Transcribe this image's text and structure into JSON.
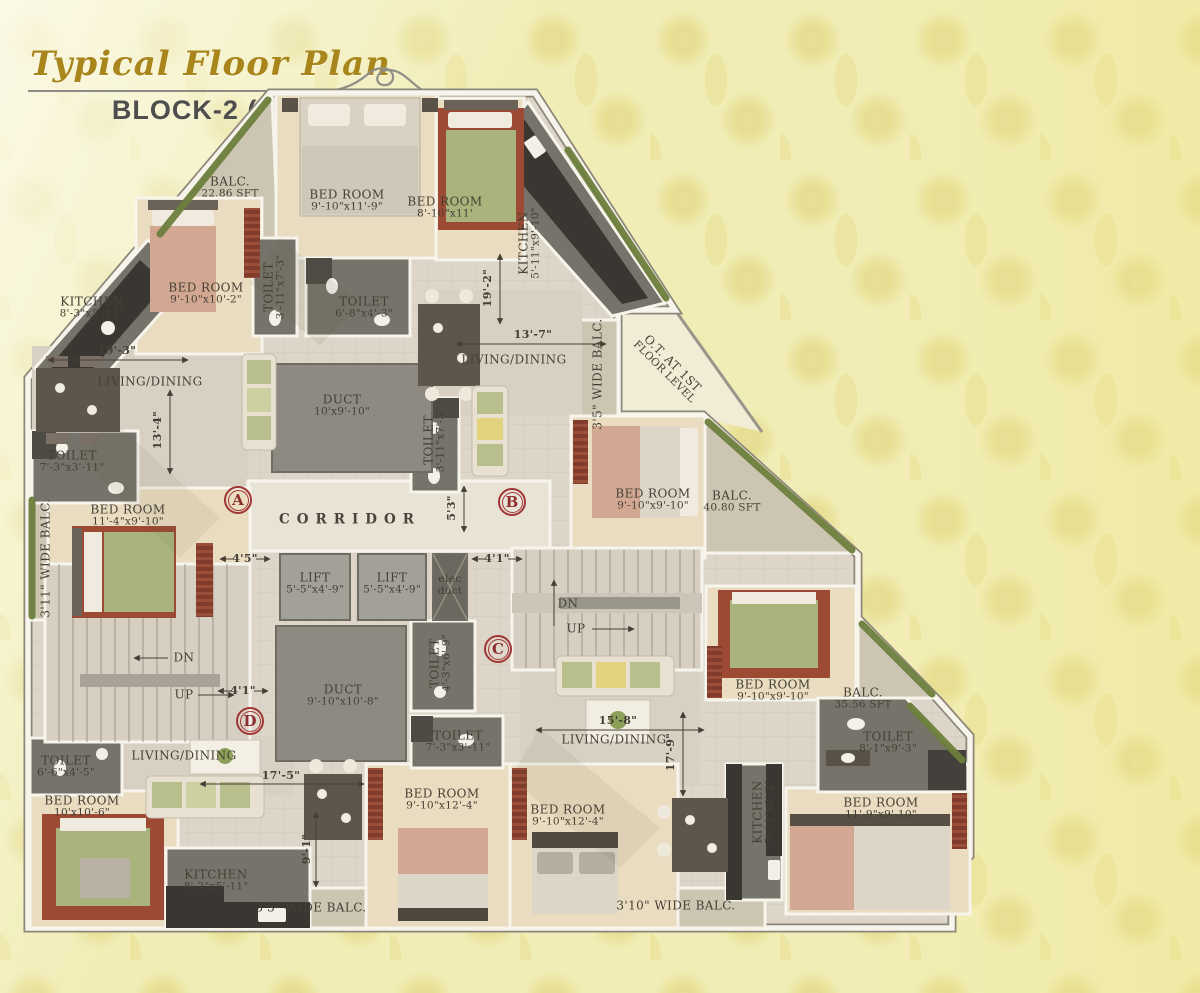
{
  "title": "Typical Floor Plan",
  "subtitle": "BLOCK-2 (G+7)",
  "colors": {
    "title_gold": "#a8861c",
    "subtitle_gray": "#4e4e4e",
    "wallpaper": "#f1edb6",
    "floor": "#ddd6c8",
    "bedroom_floor": "#eadcc0",
    "wet_area": "#76736a",
    "hedge_green": "#6d7f3d",
    "rug_green": "#a9b37c",
    "carpet_red": "#9c4a33",
    "marker_red": "#a03636",
    "label_text": "#454036"
  },
  "plan": {
    "markers": [
      {
        "letter": "A",
        "x": 218,
        "y": 412
      },
      {
        "letter": "B",
        "x": 492,
        "y": 414
      },
      {
        "letter": "C",
        "x": 478,
        "y": 561
      },
      {
        "letter": "D",
        "x": 230,
        "y": 633
      }
    ],
    "labels": [
      {
        "name": "balc-2286-label",
        "lines": [
          "BALC.",
          "22.86 SFT"
        ],
        "x": 210,
        "y": 100
      },
      {
        "name": "bedroom-1-label",
        "lines": [
          "BED ROOM",
          "9'-10\"x11'-9\""
        ],
        "x": 327,
        "y": 113
      },
      {
        "name": "bedroom-2-label",
        "lines": [
          "BED ROOM",
          "8'-10\"x11'"
        ],
        "x": 425,
        "y": 120
      },
      {
        "name": "kitchen-1-label",
        "lines": [
          "KITCHEN",
          "5'-11\"x9'-10\""
        ],
        "x": 510,
        "y": 155,
        "rot": -90
      },
      {
        "name": "kitchen-2-label",
        "lines": [
          "KITCHEN",
          "8'-3\"x5'-11\""
        ],
        "x": 72,
        "y": 220
      },
      {
        "name": "bedroom-3-label",
        "lines": [
          "BED ROOM",
          "9'-10\"x10'-2\""
        ],
        "x": 186,
        "y": 206
      },
      {
        "name": "toilet-1-label",
        "lines": [
          "TOILET",
          "3'-11\"x7'-3\""
        ],
        "x": 255,
        "y": 199,
        "rot": -90
      },
      {
        "name": "toilet-2-label",
        "lines": [
          "TOILET",
          "6'-8\"x4'-3\""
        ],
        "x": 344,
        "y": 220
      },
      {
        "name": "duct-1-label",
        "lines": [
          "DUCT",
          "10'x9'-10\""
        ],
        "x": 322,
        "y": 318
      },
      {
        "name": "dim-19-3",
        "lines": [
          "19'-3\""
        ],
        "x": 97,
        "y": 263,
        "cls": "dim"
      },
      {
        "name": "living-1-label",
        "lines": [
          "LIVING/DINING"
        ],
        "x": 130,
        "y": 294
      },
      {
        "name": "dim-13-4",
        "lines": [
          "13'-4\""
        ],
        "x": 138,
        "y": 342,
        "rot": -90,
        "cls": "dim"
      },
      {
        "name": "toilet-3-label",
        "lines": [
          "TOILET",
          "7'-3\"x3'-11\""
        ],
        "x": 52,
        "y": 374
      },
      {
        "name": "bedroom-4-label",
        "lines": [
          "BED ROOM",
          "11'-4\"x9'-10\""
        ],
        "x": 108,
        "y": 428
      },
      {
        "name": "dim-19-2",
        "lines": [
          "19'-2\""
        ],
        "x": 468,
        "y": 200,
        "rot": -90,
        "cls": "dim"
      },
      {
        "name": "dim-13-7",
        "lines": [
          "13'-7\""
        ],
        "x": 513,
        "y": 247,
        "cls": "dim"
      },
      {
        "name": "living-2-label",
        "lines": [
          "LIVING/DINING"
        ],
        "x": 494,
        "y": 272
      },
      {
        "name": "toilet-4-label",
        "lines": [
          "TOILET",
          "3'-11\"x7'-3\""
        ],
        "x": 415,
        "y": 352,
        "rot": -90
      },
      {
        "name": "balc-1-label",
        "lines": [
          "3'5\" WIDE BALC."
        ],
        "x": 578,
        "y": 286,
        "rot": -90
      },
      {
        "name": "ot-note-label",
        "lines": [
          "O.T. AT 1ST",
          "FLOOR LEVEL"
        ],
        "x": 648,
        "y": 280,
        "rot": 45
      },
      {
        "name": "bedroom-5-label",
        "lines": [
          "BED ROOM",
          "9'-10\"x9'-10\""
        ],
        "x": 633,
        "y": 412
      },
      {
        "name": "balc-4080-label",
        "lines": [
          "BALC.",
          "40.80 SFT"
        ],
        "x": 712,
        "y": 414
      },
      {
        "name": "corridor-label",
        "lines": [
          "CORRIDOR"
        ],
        "x": 330,
        "y": 432,
        "cls": "wide"
      },
      {
        "name": "dim-5-3",
        "lines": [
          "5'3\""
        ],
        "x": 432,
        "y": 420,
        "rot": -90,
        "cls": "dim"
      },
      {
        "name": "dim-4-5",
        "lines": [
          "4'5\""
        ],
        "x": 225,
        "y": 471,
        "cls": "dim"
      },
      {
        "name": "lift-1-label",
        "lines": [
          "LIFT",
          "5'-5\"x4'-9\""
        ],
        "x": 295,
        "y": 496
      },
      {
        "name": "lift-2-label",
        "lines": [
          "LIFT",
          "5'-5\"x4'-9\""
        ],
        "x": 372,
        "y": 496
      },
      {
        "name": "elec-duct-label",
        "lines": [
          "elec",
          "duct"
        ],
        "x": 430,
        "y": 498,
        "size": 10.5
      },
      {
        "name": "dim-4-1a",
        "lines": [
          "4'1\""
        ],
        "x": 477,
        "y": 471,
        "cls": "dim"
      },
      {
        "name": "stairs-right-dn-label",
        "lines": [
          "DN"
        ],
        "x": 548,
        "y": 516
      },
      {
        "name": "stairs-right-up-label",
        "lines": [
          "UP"
        ],
        "x": 556,
        "y": 541
      },
      {
        "name": "toilet-5-label",
        "lines": [
          "TOILET",
          "4'-3\"x6'-9\""
        ],
        "x": 421,
        "y": 575,
        "rot": -90
      },
      {
        "name": "balc-2-label",
        "lines": [
          "3'11\" WIDE BALC."
        ],
        "x": 26,
        "y": 470,
        "rot": -90
      },
      {
        "name": "stairs-left-dn-label",
        "lines": [
          "DN"
        ],
        "x": 164,
        "y": 570
      },
      {
        "name": "stairs-left-up-label",
        "lines": [
          "UP"
        ],
        "x": 164,
        "y": 607
      },
      {
        "name": "dim-4-1b",
        "lines": [
          "4'1\""
        ],
        "x": 223,
        "y": 603,
        "cls": "dim"
      },
      {
        "name": "duct-2-label",
        "lines": [
          "DUCT",
          "9'-10\"x10'-8\""
        ],
        "x": 323,
        "y": 608
      },
      {
        "name": "toilet-6-label",
        "lines": [
          "TOILET",
          "7'-3\"x3'-11\""
        ],
        "x": 438,
        "y": 654
      },
      {
        "name": "dim-15-8",
        "lines": [
          "15'-8\""
        ],
        "x": 598,
        "y": 633,
        "cls": "dim"
      },
      {
        "name": "living-3-label",
        "lines": [
          "LIVING/DINING"
        ],
        "x": 594,
        "y": 652
      },
      {
        "name": "dim-17-9",
        "lines": [
          "17'-9\""
        ],
        "x": 651,
        "y": 664,
        "rot": -90,
        "cls": "dim"
      },
      {
        "name": "toilet-7-label",
        "lines": [
          "TOILET",
          "8'-1\"x9'-3\""
        ],
        "x": 868,
        "y": 655
      },
      {
        "name": "toilet-8-label",
        "lines": [
          "TOILET",
          "6'-6\"x4'-5\""
        ],
        "x": 46,
        "y": 679
      },
      {
        "name": "living-4-label",
        "lines": [
          "LIVING/DINING"
        ],
        "x": 164,
        "y": 668
      },
      {
        "name": "dim-17-5",
        "lines": [
          "17'-5\""
        ],
        "x": 261,
        "y": 688,
        "cls": "dim"
      },
      {
        "name": "bedroom-6-label",
        "lines": [
          "BED ROOM",
          "10'x10'-6\""
        ],
        "x": 62,
        "y": 719
      },
      {
        "name": "kitchen-3-label",
        "lines": [
          "KITCHEN",
          "8'-2\"x5'-11\""
        ],
        "x": 196,
        "y": 793
      },
      {
        "name": "dim-9-1",
        "lines": [
          "9'-1\""
        ],
        "x": 287,
        "y": 761,
        "rot": -90,
        "cls": "dim"
      },
      {
        "name": "bedroom-7-label",
        "lines": [
          "BED ROOM",
          "9'-10\"x12'-4\""
        ],
        "x": 422,
        "y": 712
      },
      {
        "name": "bedroom-8-label",
        "lines": [
          "BED ROOM",
          "9'-10\"x12'-4\""
        ],
        "x": 548,
        "y": 728
      },
      {
        "name": "balc-3-label",
        "lines": [
          "3'3\" WIDE BALC."
        ],
        "x": 291,
        "y": 820
      },
      {
        "name": "balc-4-label",
        "lines": [
          "3'10\" WIDE BALC."
        ],
        "x": 656,
        "y": 818
      },
      {
        "name": "kitchen-4-label",
        "lines": [
          "KITCHEN",
          "5'-11\"x8'-2\""
        ],
        "x": 744,
        "y": 724,
        "rot": -90
      },
      {
        "name": "bedroom-9-label",
        "lines": [
          "BED ROOM",
          "11'-9\"x9'-10\""
        ],
        "x": 861,
        "y": 721
      },
      {
        "name": "bedroom-10-label",
        "lines": [
          "BED ROOM",
          "9'-10\"x9'-10\""
        ],
        "x": 753,
        "y": 603
      },
      {
        "name": "balc-3556-label",
        "lines": [
          "BALC.",
          "35.56 SFT"
        ],
        "x": 843,
        "y": 611
      }
    ]
  }
}
